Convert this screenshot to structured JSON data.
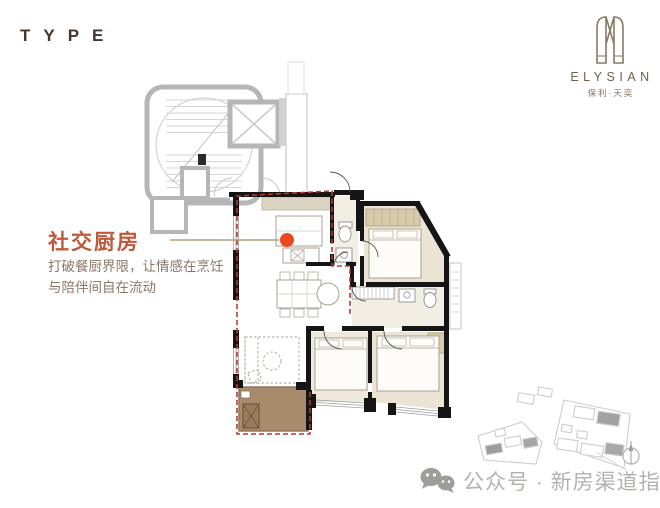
{
  "page": {
    "background": "#ffffff"
  },
  "header": {
    "type_label": "TYPE"
  },
  "brand": {
    "name_en": "ELYSIAN",
    "name_cn": "保利·天奕",
    "emblem_icon": "elysian-gate-emblem",
    "color": "#8a7963"
  },
  "callout": {
    "title": "社交厨房",
    "description_line1": "打破餐厨界限，让情感在烹饪",
    "description_line2": "与陪伴间自在流动",
    "title_color": "#c0583c",
    "marker_dot_color": "#e8491d",
    "marker_room": "kitchen"
  },
  "floorplan": {
    "unit_boundary_color": "#b23b32",
    "wall_color": "#151515",
    "core_wall_color": "#b6b6b6",
    "balcony_fill": "#a88a6c",
    "floor_tint": "#ebe4d4",
    "rooms": [
      "stair-core",
      "elevator",
      "corridor",
      "kitchen",
      "bath-1",
      "master-bedroom",
      "hall",
      "dining",
      "living-room",
      "bath-2",
      "bedroom-2",
      "bedroom-3",
      "balcony"
    ]
  },
  "siteplan": {
    "name": "site-key-plan",
    "compass_icon": "north-compass"
  },
  "watermark": {
    "icon": "wechat-icon",
    "label": "公众号 · 新房渠道指南",
    "color": "#b4b1ae"
  }
}
